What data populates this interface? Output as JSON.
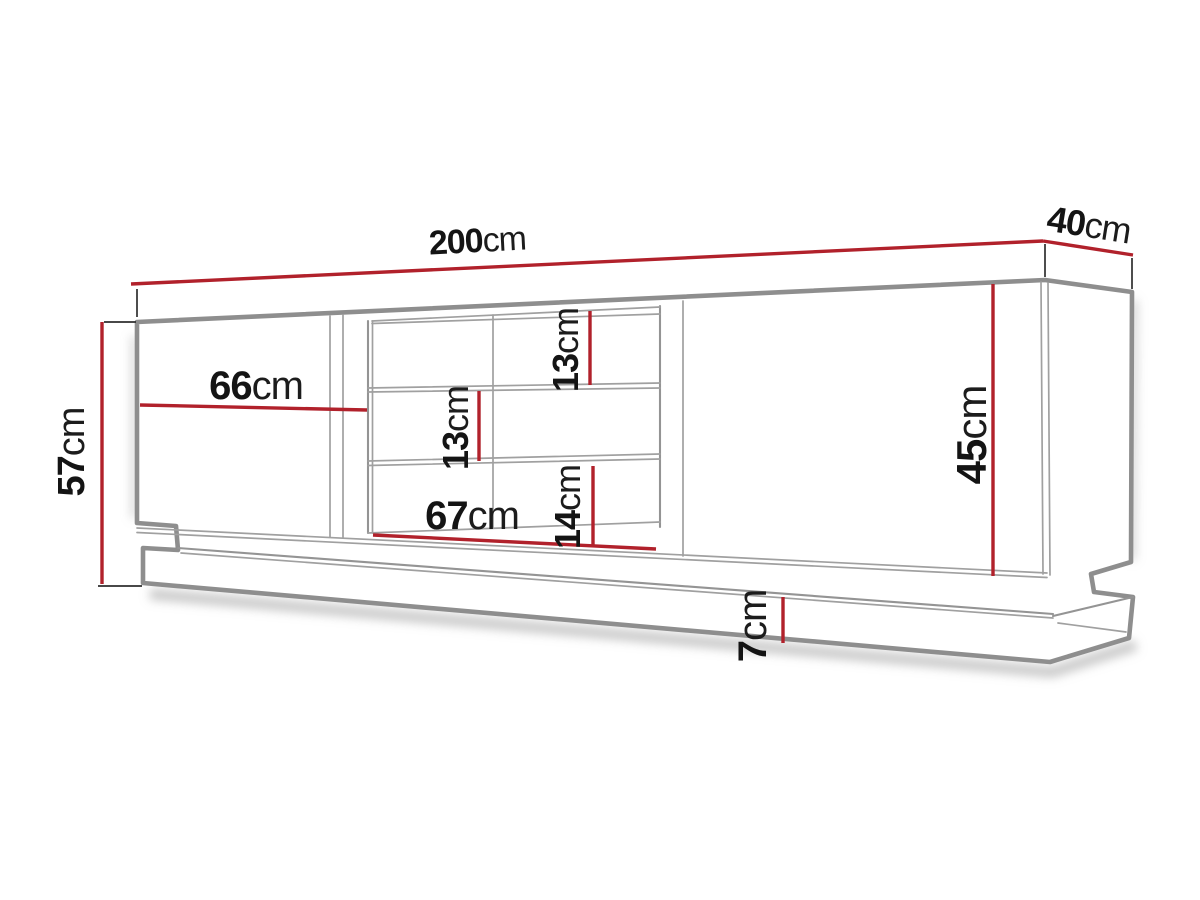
{
  "dimensions": {
    "total_width": {
      "value": "200",
      "unit": "cm"
    },
    "depth": {
      "value": "40",
      "unit": "cm"
    },
    "total_height": {
      "value": "57",
      "unit": "cm"
    },
    "door_width": {
      "value": "66",
      "unit": "cm"
    },
    "shelf_top_height": {
      "value": "13",
      "unit": "cm"
    },
    "shelf_middle_height": {
      "value": "13",
      "unit": "cm"
    },
    "shelf_bottom_height": {
      "value": "14",
      "unit": "cm"
    },
    "niche_width": {
      "value": "67",
      "unit": "cm"
    },
    "front_height": {
      "value": "45",
      "unit": "cm"
    },
    "base_height": {
      "value": "7",
      "unit": "cm"
    }
  },
  "colors": {
    "dimension_line_red": "#b1212b",
    "drawing_outline_gray": "#8e8e8e",
    "drawing_line_gray": "#a0a0a0",
    "label_text_black": "#141414",
    "background": "#ffffff"
  }
}
